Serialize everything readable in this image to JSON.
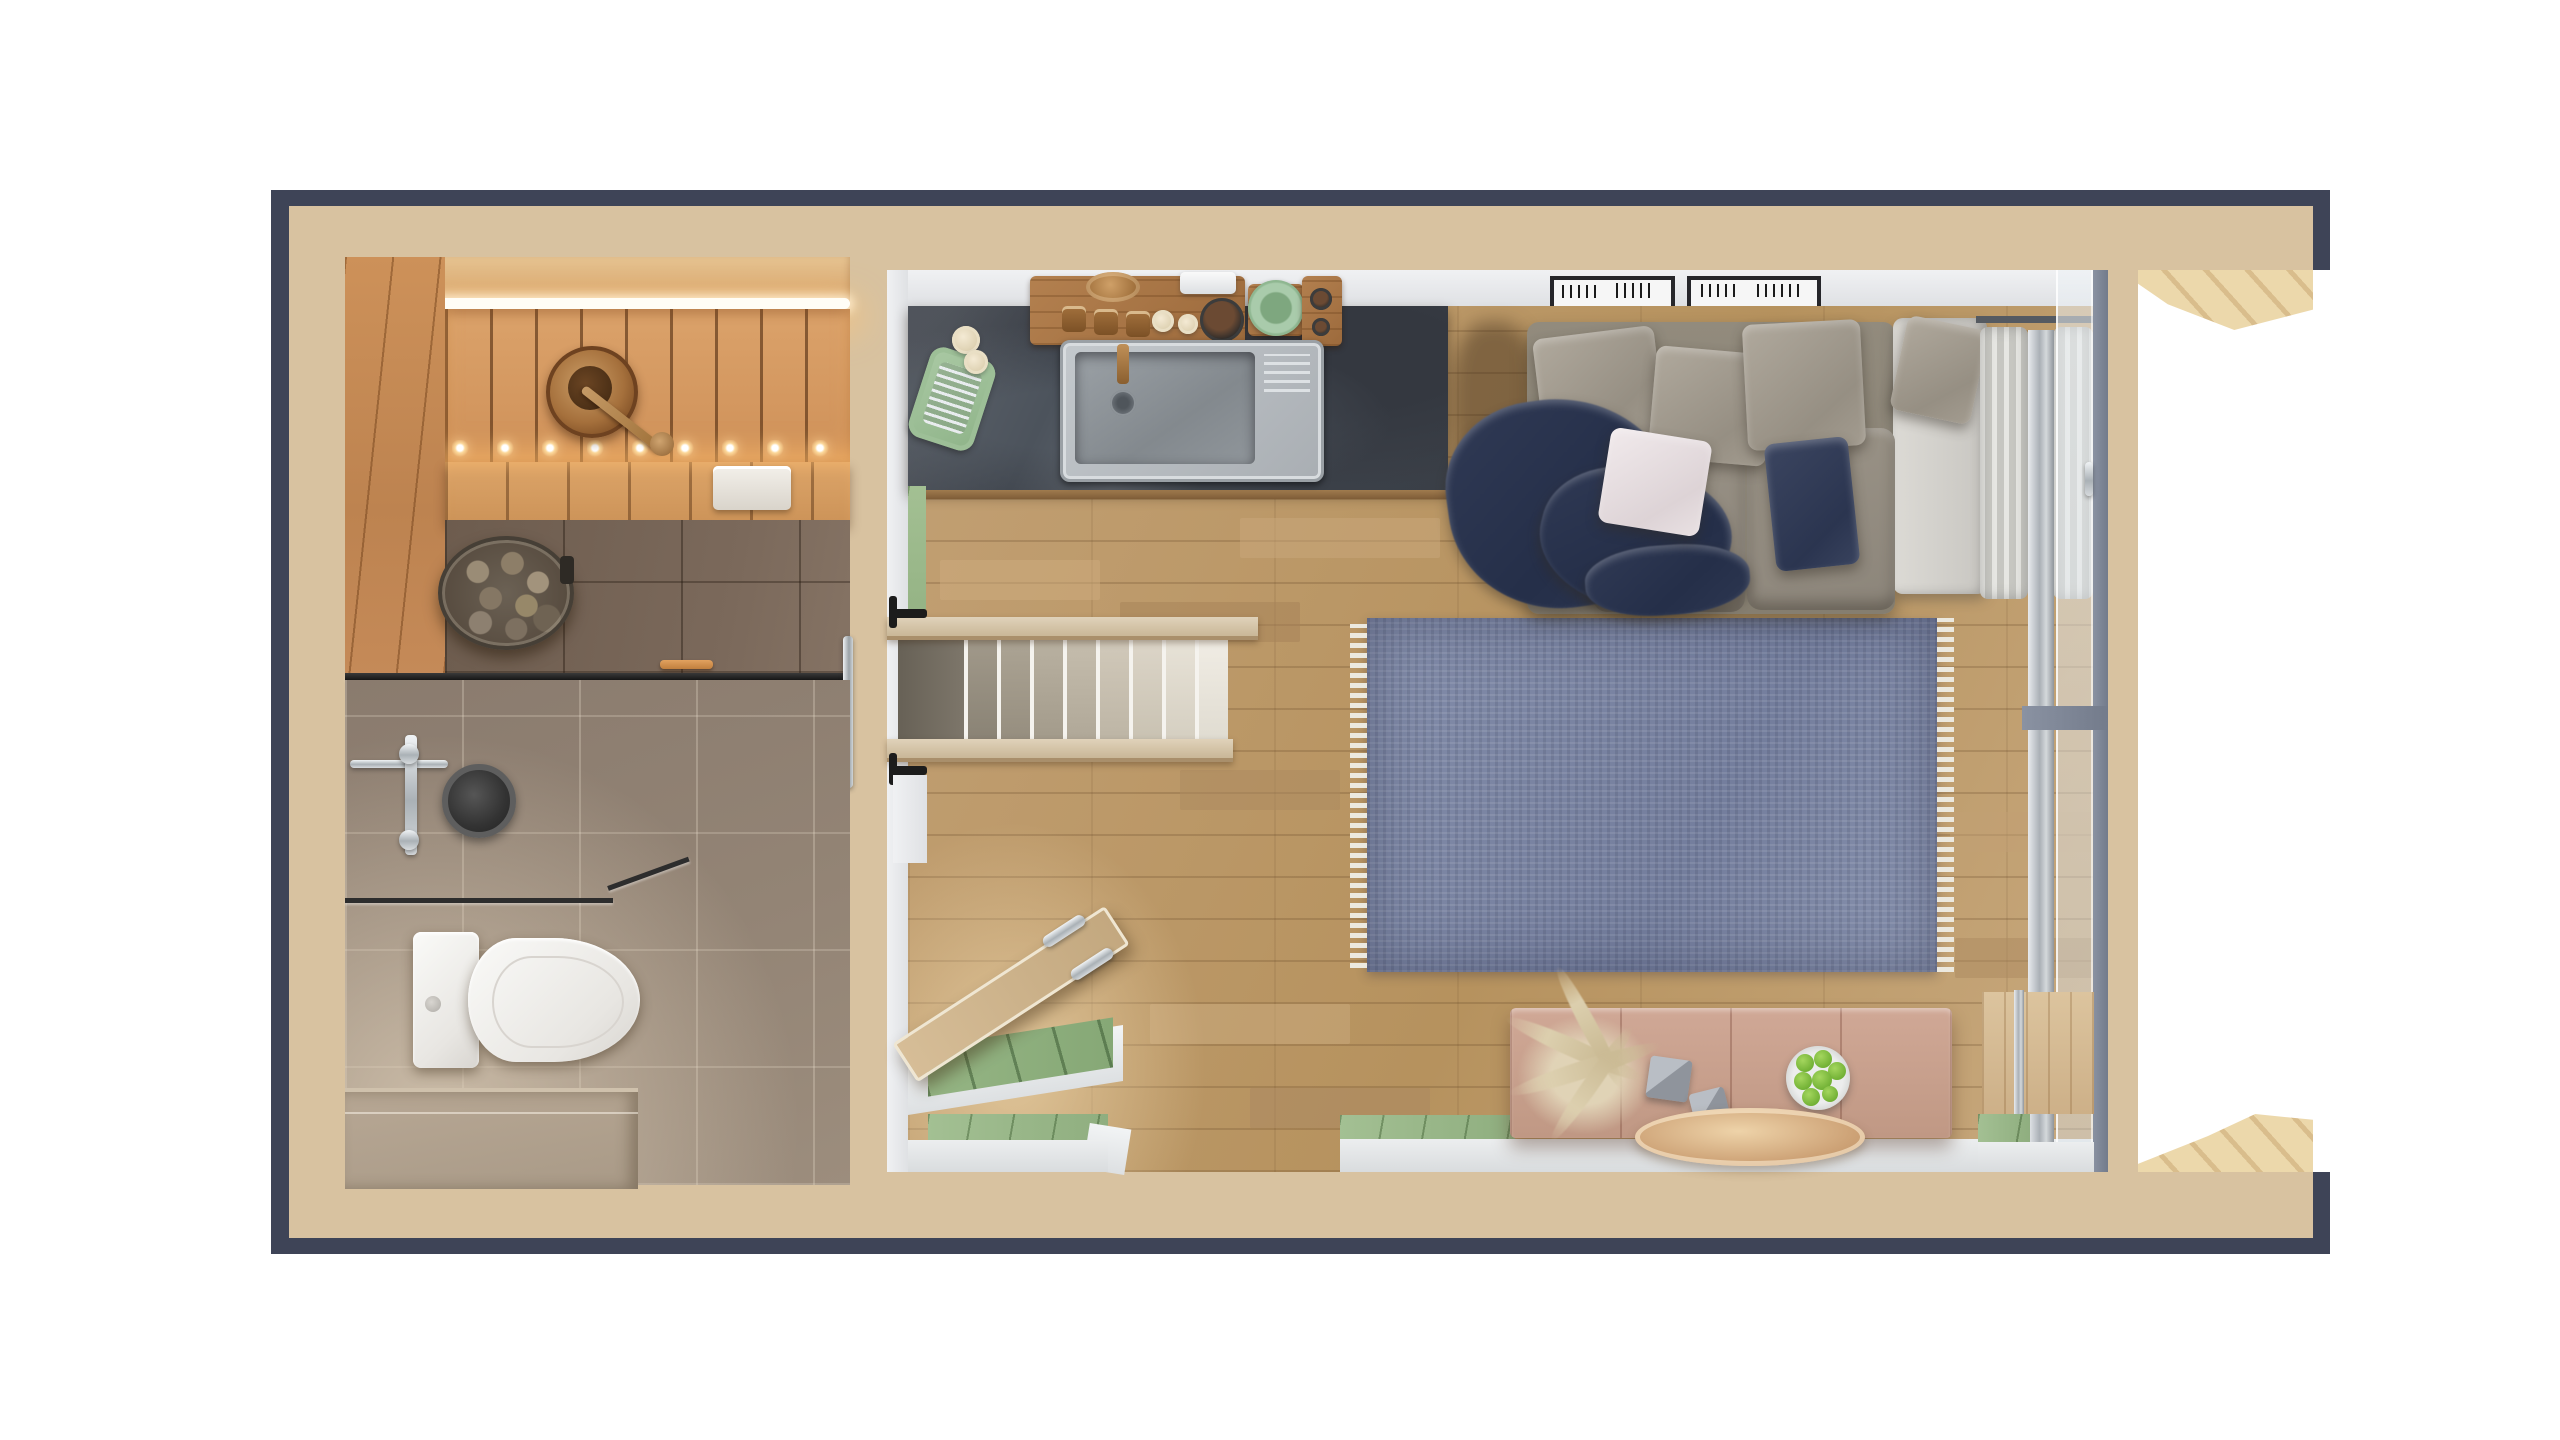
{
  "meta": {
    "description": "Top-down 3D rendered floor plan of a tiny house: sauna and bathroom on the left, open living space with kitchen, staircase, sofa and terrace on the right",
    "visible_text": []
  },
  "palette": {
    "navy": "#3e4457",
    "tan": "#d8c2a0",
    "white_wall": "#e9ebed",
    "sage_green": "#9ab98a",
    "oak_floor": "#bb video#bb9a6f",
    "oak": "#bb9a6f",
    "slate_counter": "#3f444c",
    "sauna_wood": "#d0955e",
    "sauna_tile": "#756455",
    "bath_tile": "#938475",
    "rug_blue": "#7d87a5",
    "sofa_gray": "#9a948a",
    "textile_navy": "#2c364f",
    "pink_table": "#c9a18d",
    "copper_tray": "#cda276",
    "deck_birch": "#e4cda2",
    "steel": "#b9bec3",
    "led_warm": "#ffd9a0"
  },
  "rooms": [
    {
      "id": "sauna",
      "features": [
        "led-light-strip",
        "backrest-bench-leds",
        "upper-bench",
        "lower-bench",
        "towel",
        "wooden-bucket-with-ladle",
        "stone-heater-basket",
        "glass-partition",
        "towel-bars"
      ]
    },
    {
      "id": "bathroom",
      "features": [
        "rain-shower-head",
        "shower-valve",
        "glass-shower-screen",
        "wall-hung-toilet",
        "tiled-step"
      ]
    },
    {
      "id": "living-kitchen",
      "features": [
        "slate-kitchen-counter",
        "sink",
        "dish-rack",
        "herb-plant",
        "spice-board",
        "green-plate-set",
        "staircase",
        "handrails",
        "open-floor-hatch",
        "entry-mat",
        "blue-rug",
        "sofa",
        "pillows",
        "navy-blanket",
        "chaise",
        "curtains",
        "sliding-glass-wall",
        "pink-sideboard",
        "pampas-decor",
        "concrete-cubes",
        "apple-bowl",
        "copper-tray",
        "wall-vents"
      ]
    },
    {
      "id": "terrace",
      "features": [
        "diagonal-deck-planks-top",
        "diagonal-deck-planks-bottom"
      ]
    }
  ],
  "counts": {
    "stair_steps": 8,
    "sofa_back_pillows": 3,
    "seat_cushions": 2,
    "apples": 7,
    "wall_vents": 2,
    "curtain_panels": 2
  }
}
